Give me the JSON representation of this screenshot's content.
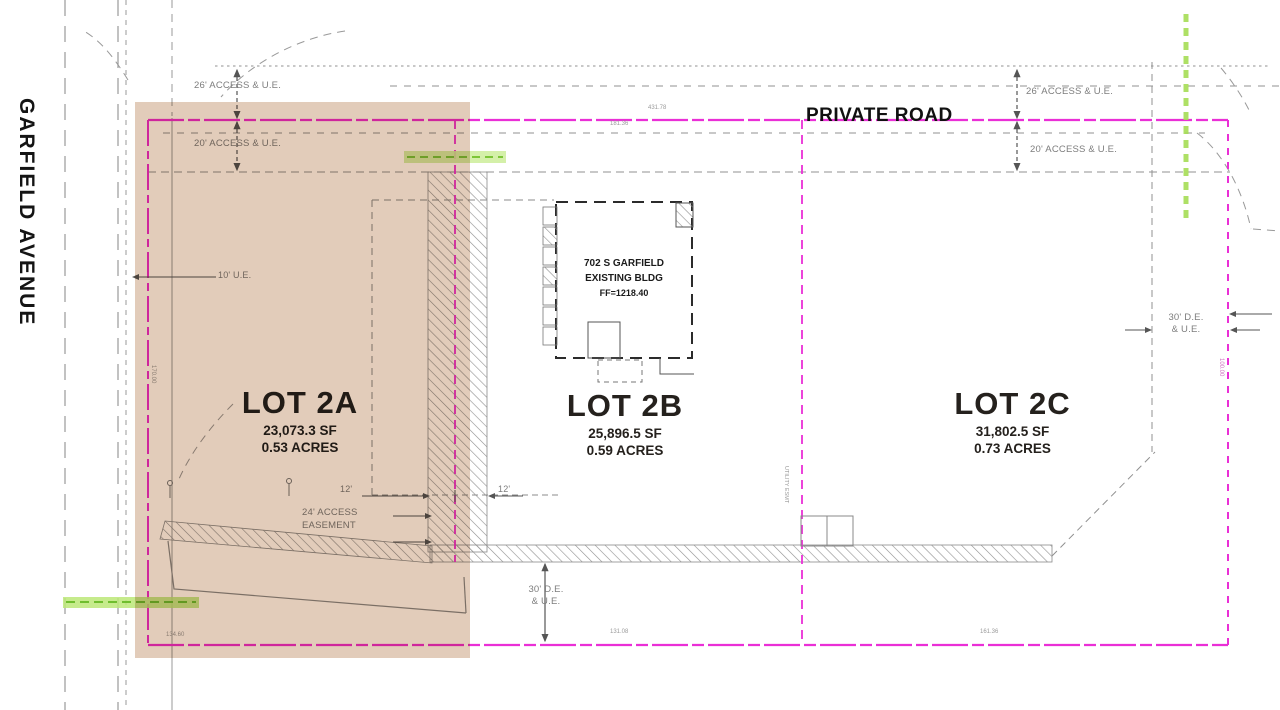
{
  "street": {
    "name": "GARFIELD AVENUE"
  },
  "road": {
    "name": "PRIVATE ROAD"
  },
  "lots": [
    {
      "name": "LOT 2A",
      "area_sf": "23,073.3 SF",
      "area_acres": "0.53 ACRES"
    },
    {
      "name": "LOT 2B",
      "area_sf": "25,896.5 SF",
      "area_acres": "0.59 ACRES"
    },
    {
      "name": "LOT 2C",
      "area_sf": "31,802.5 SF",
      "area_acres": "0.73 ACRES"
    }
  ],
  "building": {
    "address": "702 S GARFIELD",
    "label": "EXISTING BLDG",
    "finish_floor": "FF=1218.40"
  },
  "easements": {
    "access26_left": "26' ACCESS & U.E.",
    "access20_left": "20' ACCESS & U.E.",
    "access26_right": "26' ACCESS & U.E.",
    "access20_right": "20' ACCESS & U.E.",
    "ue10": "10' U.E.",
    "access24_line1": "24' ACCESS",
    "access24_line2": "EASEMENT",
    "dim12_left": "12'",
    "dim12_right": "12'",
    "de30_bottom_line1": "30' D.E.",
    "de30_bottom_line2": "& U.E.",
    "de30_right_line1": "30' D.E.",
    "de30_right_line2": "& U.E.",
    "utility_esmt": "UTILITY ESMT"
  },
  "dimensions": {
    "top_center": "431.78",
    "top_center2": "181.36",
    "bottom_center": "131.08",
    "bottom_right": "161.36",
    "bottom_left": "134.60",
    "left_side": "170.00",
    "right_side": "100.00"
  },
  "colors": {
    "lot_line": "#ea2fd6",
    "highlight": "#c59a76",
    "utility_green": "#8cd24a",
    "linework_gray": "#8b8b8b"
  }
}
